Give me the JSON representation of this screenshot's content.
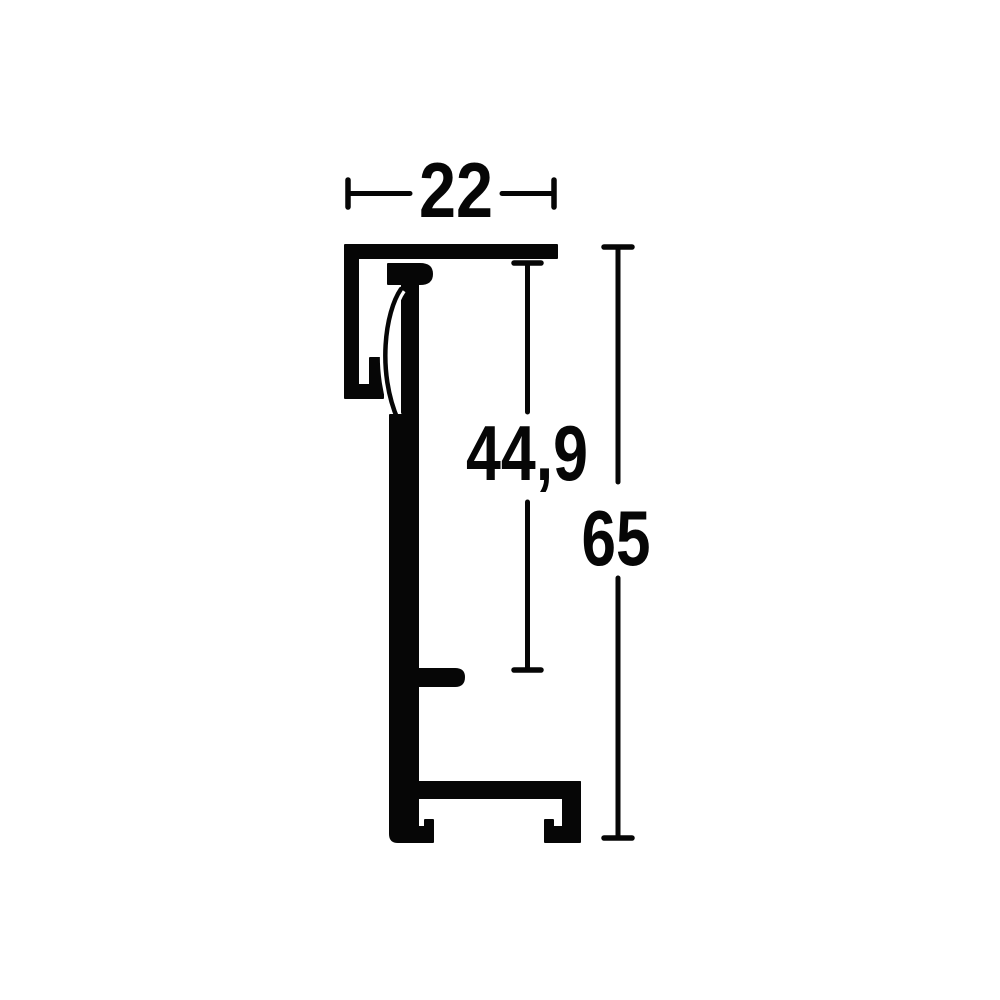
{
  "drawing": {
    "type": "technical-profile-cross-section",
    "labels": {
      "width": "22",
      "inner_height": "44,9",
      "outer_height": "65"
    },
    "colors": {
      "line": "#060606",
      "background": "#ffffff"
    }
  }
}
